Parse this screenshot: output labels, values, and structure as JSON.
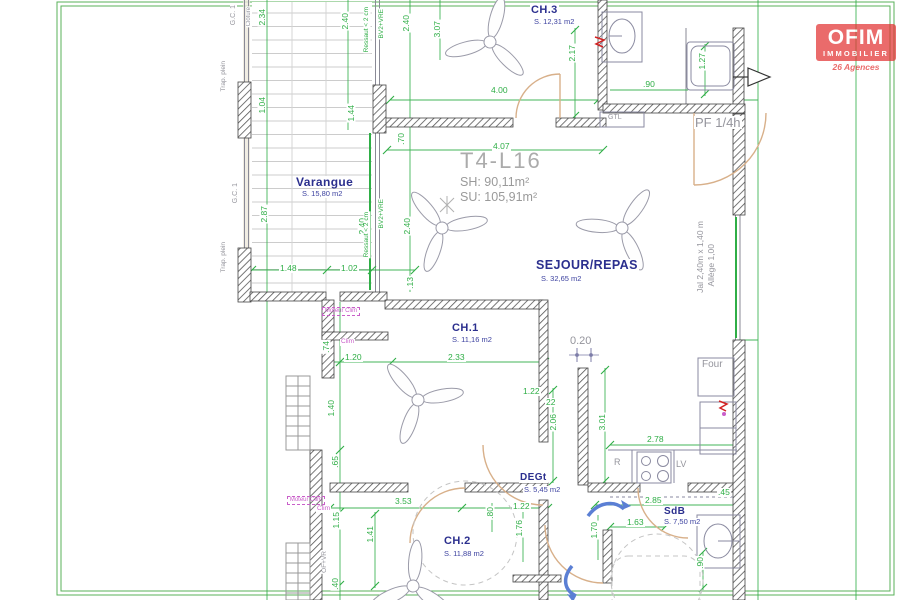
{
  "logo": {
    "brand": "OFIM",
    "sub": "IMMOBILIER",
    "tagline": "26 Agences"
  },
  "title": {
    "name": "T4-L16",
    "sh": "SH: 90,11m²",
    "su": "SU: 105,91m²"
  },
  "rooms": [
    {
      "name": "CH.3",
      "area": "S. 12,31 m2",
      "x": 530,
      "y": 5,
      "s": 11,
      "ax": 533,
      "ay": 18
    },
    {
      "name": "Varangue",
      "area": "S. 15,80 m2",
      "x": 295,
      "y": 176,
      "s": 12,
      "ax": 301,
      "ay": 190
    },
    {
      "name": "SEJOUR/REPAS",
      "area": "S. 32,65 m2",
      "x": 535,
      "y": 259,
      "s": 12.5,
      "ax": 540,
      "ay": 275
    },
    {
      "name": "CH.1",
      "area": "S. 11,16 m2",
      "x": 451,
      "y": 323,
      "s": 11,
      "ax": 451,
      "ay": 336
    },
    {
      "name": "DEGt",
      "area": "S. 5,45 m2",
      "x": 519,
      "y": 473,
      "s": 10,
      "ax": 523,
      "ay": 486
    },
    {
      "name": "SdB",
      "area": "S. 7,50 m2",
      "x": 663,
      "y": 507,
      "s": 10,
      "ax": 663,
      "ay": 518
    },
    {
      "name": "CH.2",
      "area": "S. 11,88 m2",
      "x": 443,
      "y": 536,
      "s": 11,
      "ax": 443,
      "ay": 550
    }
  ],
  "gray_labels": [
    {
      "t": "G.C. 1",
      "x": 230,
      "y": 4,
      "s": 7,
      "v": 1
    },
    {
      "t": "Clôture",
      "x": 246,
      "y": 6,
      "s": 6,
      "v": 1
    },
    {
      "t": "Trap. plein",
      "x": 221,
      "y": 60,
      "s": 6.5,
      "v": 1
    },
    {
      "t": "GTL",
      "x": 607,
      "y": 114,
      "s": 7
    },
    {
      "t": "PF 1/4h",
      "x": 694,
      "y": 116,
      "s": 13
    },
    {
      "t": "G.C. 1",
      "x": 232,
      "y": 182,
      "s": 7,
      "v": 1
    },
    {
      "t": "Jal 2,40m x 1,40 m",
      "x": 696,
      "y": 220,
      "s": 8.5,
      "v": 1
    },
    {
      "t": "Allège 1,00",
      "x": 707,
      "y": 243,
      "s": 8.5,
      "v": 1
    },
    {
      "t": "Trap. plein",
      "x": 221,
      "y": 241,
      "s": 6.5,
      "v": 1
    },
    {
      "t": "0.20",
      "x": 569,
      "y": 336,
      "s": 11
    },
    {
      "t": "Four",
      "x": 701,
      "y": 360,
      "s": 10
    },
    {
      "t": "R",
      "x": 613,
      "y": 458,
      "s": 9
    },
    {
      "t": "LV",
      "x": 675,
      "y": 460,
      "s": 9
    },
    {
      "t": "OF+VR",
      "x": 322,
      "y": 550,
      "s": 6.5,
      "v": 1
    }
  ],
  "magenta_labels": [
    {
      "t": "Moteur Clim",
      "x": 322,
      "y": 307,
      "box": 1
    },
    {
      "t": "Clim",
      "x": 340,
      "y": 339
    },
    {
      "t": "Moteur Clim",
      "x": 287,
      "y": 496,
      "box": 1
    },
    {
      "t": "Clim",
      "x": 316,
      "y": 506
    }
  ],
  "green_texts": [
    {
      "t": "Ressaut < 2 cm",
      "x": 364,
      "y": 6
    },
    {
      "t": "BV2+VRE",
      "x": 379,
      "y": 8
    },
    {
      "t": "BV2+VRE",
      "x": 379,
      "y": 198
    },
    {
      "t": "Ressaut < 2 cm",
      "x": 364,
      "y": 211
    }
  ],
  "dimensions": [
    {
      "t": "2.34",
      "x": 258,
      "y": 8,
      "v": 1
    },
    {
      "t": "2.40",
      "x": 341,
      "y": 12,
      "v": 1
    },
    {
      "t": "2.40",
      "x": 402,
      "y": 14,
      "v": 1
    },
    {
      "t": "3.07",
      "x": 433,
      "y": 20,
      "v": 1
    },
    {
      "t": "2.17",
      "x": 568,
      "y": 44,
      "v": 1
    },
    {
      "t": "1.27",
      "x": 698,
      "y": 52,
      "v": 1
    },
    {
      "t": ".90",
      "x": 642,
      "y": 80
    },
    {
      "t": "4.00",
      "x": 490,
      "y": 86
    },
    {
      "t": "1.04",
      "x": 258,
      "y": 96,
      "v": 1
    },
    {
      "t": "1.44",
      "x": 347,
      "y": 104,
      "v": 1
    },
    {
      "t": ".70",
      "x": 397,
      "y": 132,
      "v": 1
    },
    {
      "t": "4.07",
      "x": 492,
      "y": 142
    },
    {
      "t": "2.87",
      "x": 260,
      "y": 205,
      "v": 1
    },
    {
      "t": "2.40",
      "x": 358,
      "y": 217,
      "v": 1
    },
    {
      "t": "2.40",
      "x": 403,
      "y": 217,
      "v": 1
    },
    {
      "t": "1.48",
      "x": 279,
      "y": 264
    },
    {
      "t": "1.02",
      "x": 340,
      "y": 264
    },
    {
      "t": ".13",
      "x": 406,
      "y": 276,
      "v": 1
    },
    {
      "t": ".74",
      "x": 322,
      "y": 340,
      "v": 1
    },
    {
      "t": "1.20",
      "x": 344,
      "y": 353
    },
    {
      "t": "2.33",
      "x": 447,
      "y": 353
    },
    {
      "t": "1.22",
      "x": 522,
      "y": 387
    },
    {
      "t": "22",
      "x": 545,
      "y": 398
    },
    {
      "t": "1.40",
      "x": 327,
      "y": 399,
      "v": 1
    },
    {
      "t": "2.06",
      "x": 549,
      "y": 413,
      "v": 1
    },
    {
      "t": "3.01",
      "x": 598,
      "y": 413,
      "v": 1
    },
    {
      "t": "2.78",
      "x": 646,
      "y": 435
    },
    {
      "t": ".65",
      "x": 331,
      "y": 455,
      "v": 1
    },
    {
      "t": ".45",
      "x": 717,
      "y": 488
    },
    {
      "t": "2.85",
      "x": 644,
      "y": 496
    },
    {
      "t": "3.53",
      "x": 394,
      "y": 497
    },
    {
      "t": "1.22",
      "x": 512,
      "y": 502
    },
    {
      "t": ".80",
      "x": 486,
      "y": 506,
      "v": 1
    },
    {
      "t": "1.15",
      "x": 332,
      "y": 511,
      "v": 1
    },
    {
      "t": "1.63",
      "x": 626,
      "y": 518
    },
    {
      "t": "1.76",
      "x": 515,
      "y": 519,
      "v": 1
    },
    {
      "t": "1.70",
      "x": 590,
      "y": 521,
      "v": 1
    },
    {
      "t": "1.41",
      "x": 366,
      "y": 525,
      "v": 1
    },
    {
      "t": ".90",
      "x": 696,
      "y": 556,
      "v": 1
    },
    {
      "t": ".40",
      "x": 331,
      "y": 577,
      "v": 1
    }
  ],
  "colors": {
    "dimension_green": "#2fae46",
    "room_blue": "#2b2f8e",
    "wall_gray": "#4a4a4a",
    "label_gray": "#94949c",
    "clim_magenta": "#c95fc9",
    "logo_red": "#e23333",
    "door_tan": "#d8b08a",
    "arrow_blue": "#5b7fd4",
    "frame_green": "#58b158"
  }
}
